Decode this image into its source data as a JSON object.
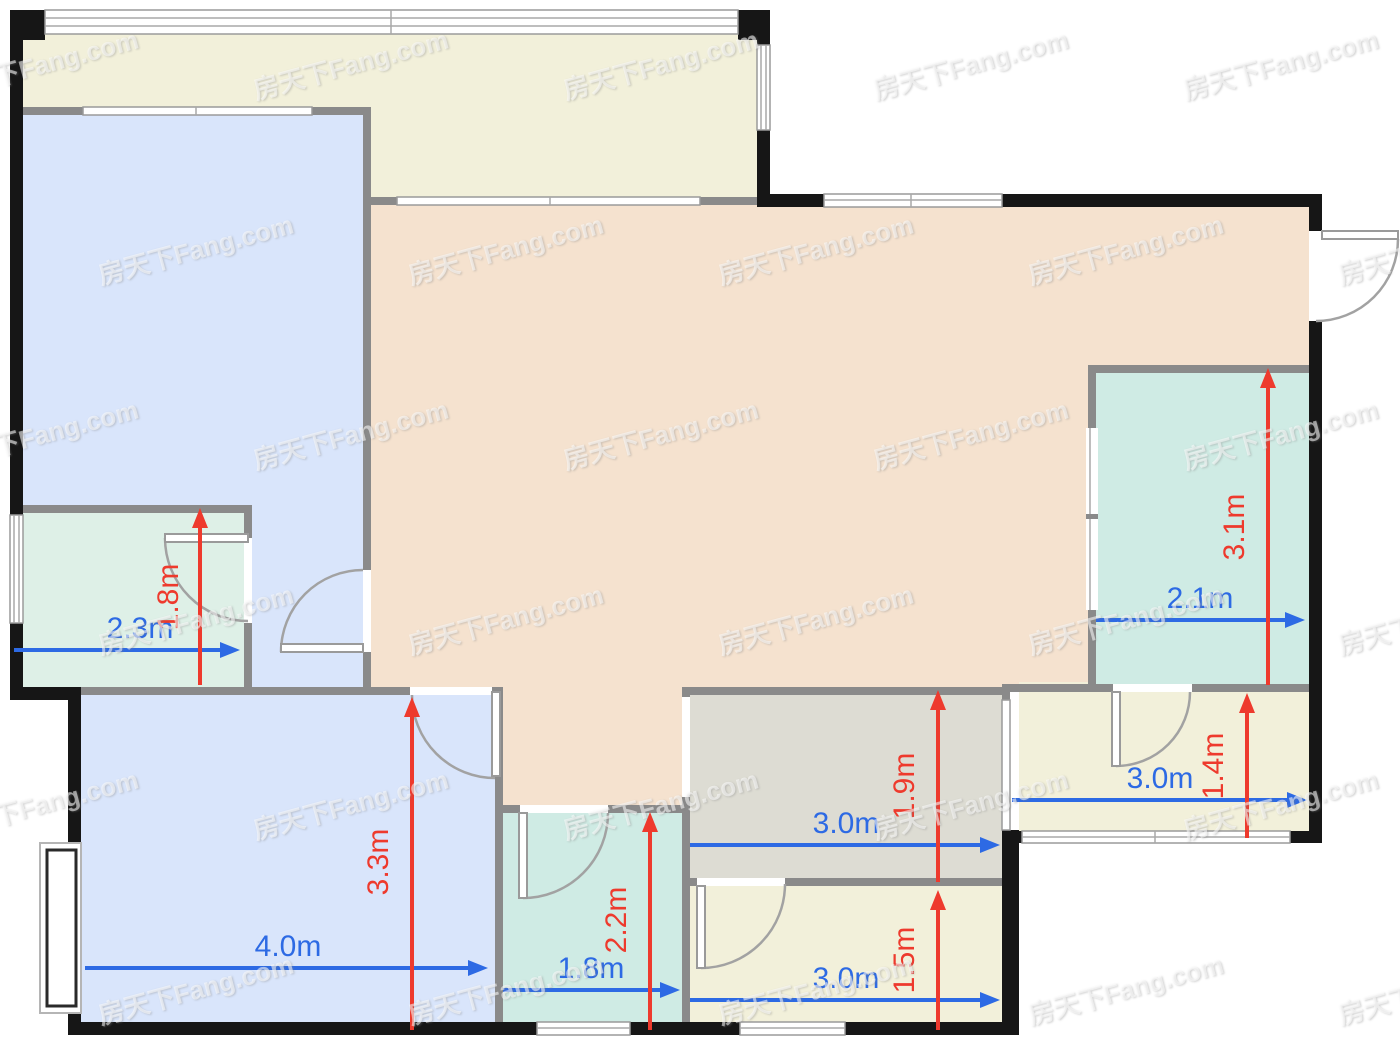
{
  "plan": {
    "watermark_text": "房天下Fang.com",
    "units": "m",
    "colors": {
      "dim_horizontal": "#2d6ae4",
      "dim_vertical": "#ee3a2d",
      "wall_exterior": "#161616",
      "wall_interior": "#8a8a8a",
      "room_balcony": "#f2f0da",
      "room_blue": "#d9e5fb",
      "room_living": "#f5e2cf",
      "room_green": "#def0e7",
      "room_teal": "#cfebe4",
      "room_kitchen": "#dddcd3",
      "room_cream": "#f2f0da"
    },
    "dims": {
      "green_width": "2.3m",
      "green_depth": "1.8m",
      "bedroom_width": "4.0m",
      "bedroom_depth": "3.3m",
      "hall_bath_width": "1.8m",
      "hall_bath_depth": "2.2m",
      "kitchen_width": "3.0m",
      "kitchen_depth": "1.9m",
      "south_room_width": "3.0m",
      "south_room_depth": "1.5m",
      "east_room_width": "3.0m",
      "east_room_depth": "1.4m",
      "east_bath_width": "2.1m",
      "east_bath_depth": "3.1m"
    },
    "rooms": [
      {
        "id": "green-room",
        "width": "2.3m",
        "depth": "1.8m"
      },
      {
        "id": "bottom-bedroom",
        "width": "4.0m",
        "depth": "3.3m"
      },
      {
        "id": "hall-bathroom",
        "width": "1.8m",
        "depth": "2.2m"
      },
      {
        "id": "kitchen",
        "width": "3.0m",
        "depth": "1.9m"
      },
      {
        "id": "south-room",
        "width": "3.0m",
        "depth": "1.5m"
      },
      {
        "id": "east-room",
        "width": "3.0m",
        "depth": "1.4m"
      },
      {
        "id": "east-bathroom",
        "width": "2.1m",
        "depth": "3.1m"
      }
    ]
  }
}
